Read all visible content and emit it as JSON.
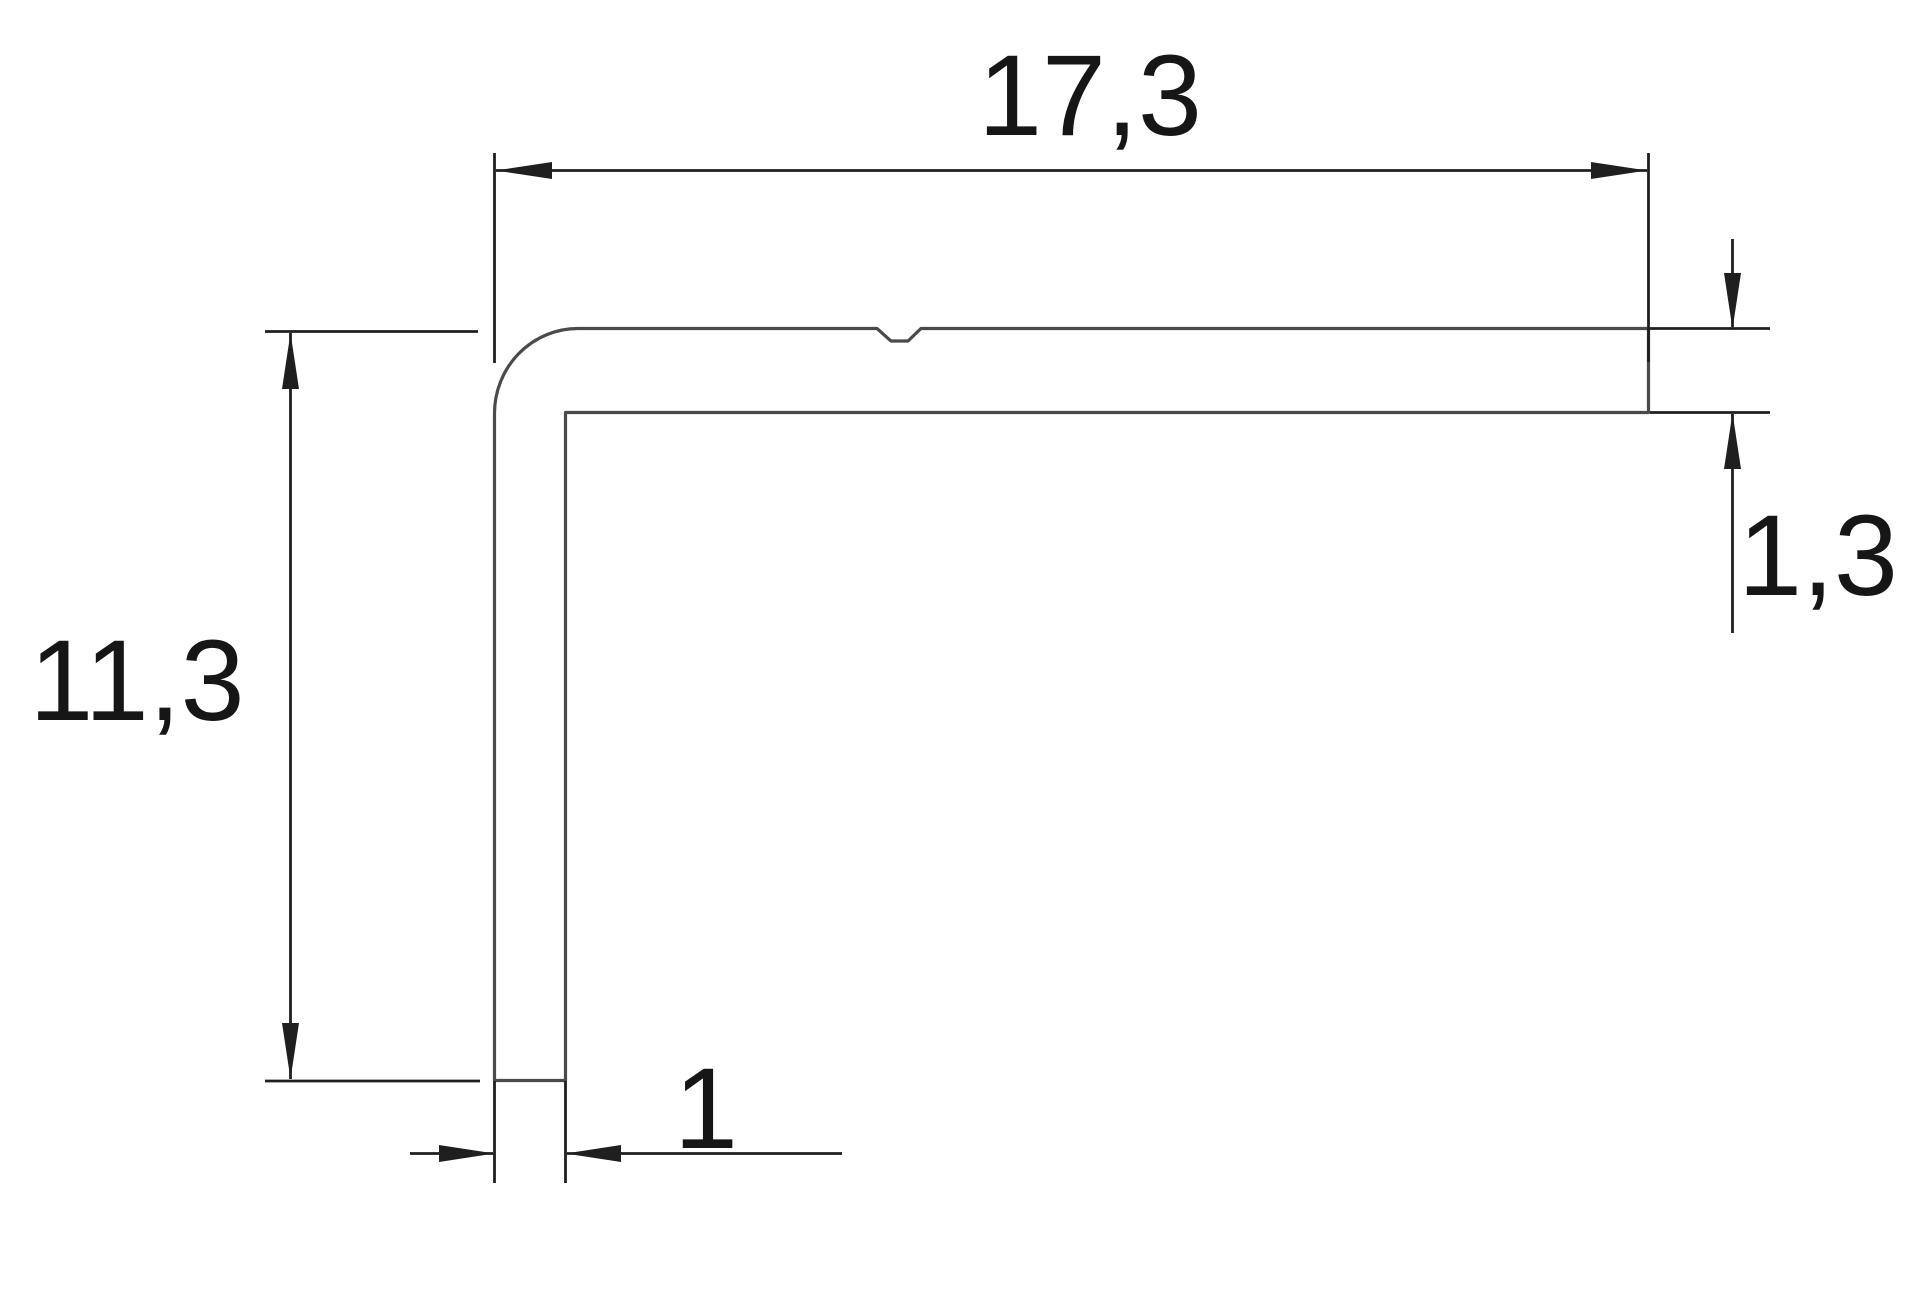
{
  "drawing": {
    "kind": "technical-dimension-drawing",
    "subject": "L-shaped angle profile cross-section",
    "dimensions": {
      "top_width": {
        "label": "17,3",
        "value": 17.3
      },
      "left_height": {
        "label": "11,3",
        "value": 11.3
      },
      "right_thickness": {
        "label": "1,3",
        "value": 1.3
      },
      "bottom_thickness": {
        "label": "1",
        "value": 1
      }
    },
    "colors": {
      "background": "#ffffff",
      "profile_line": "#4a4a4a",
      "dimension_line": "#1f1f1f",
      "text": "#161616"
    }
  }
}
